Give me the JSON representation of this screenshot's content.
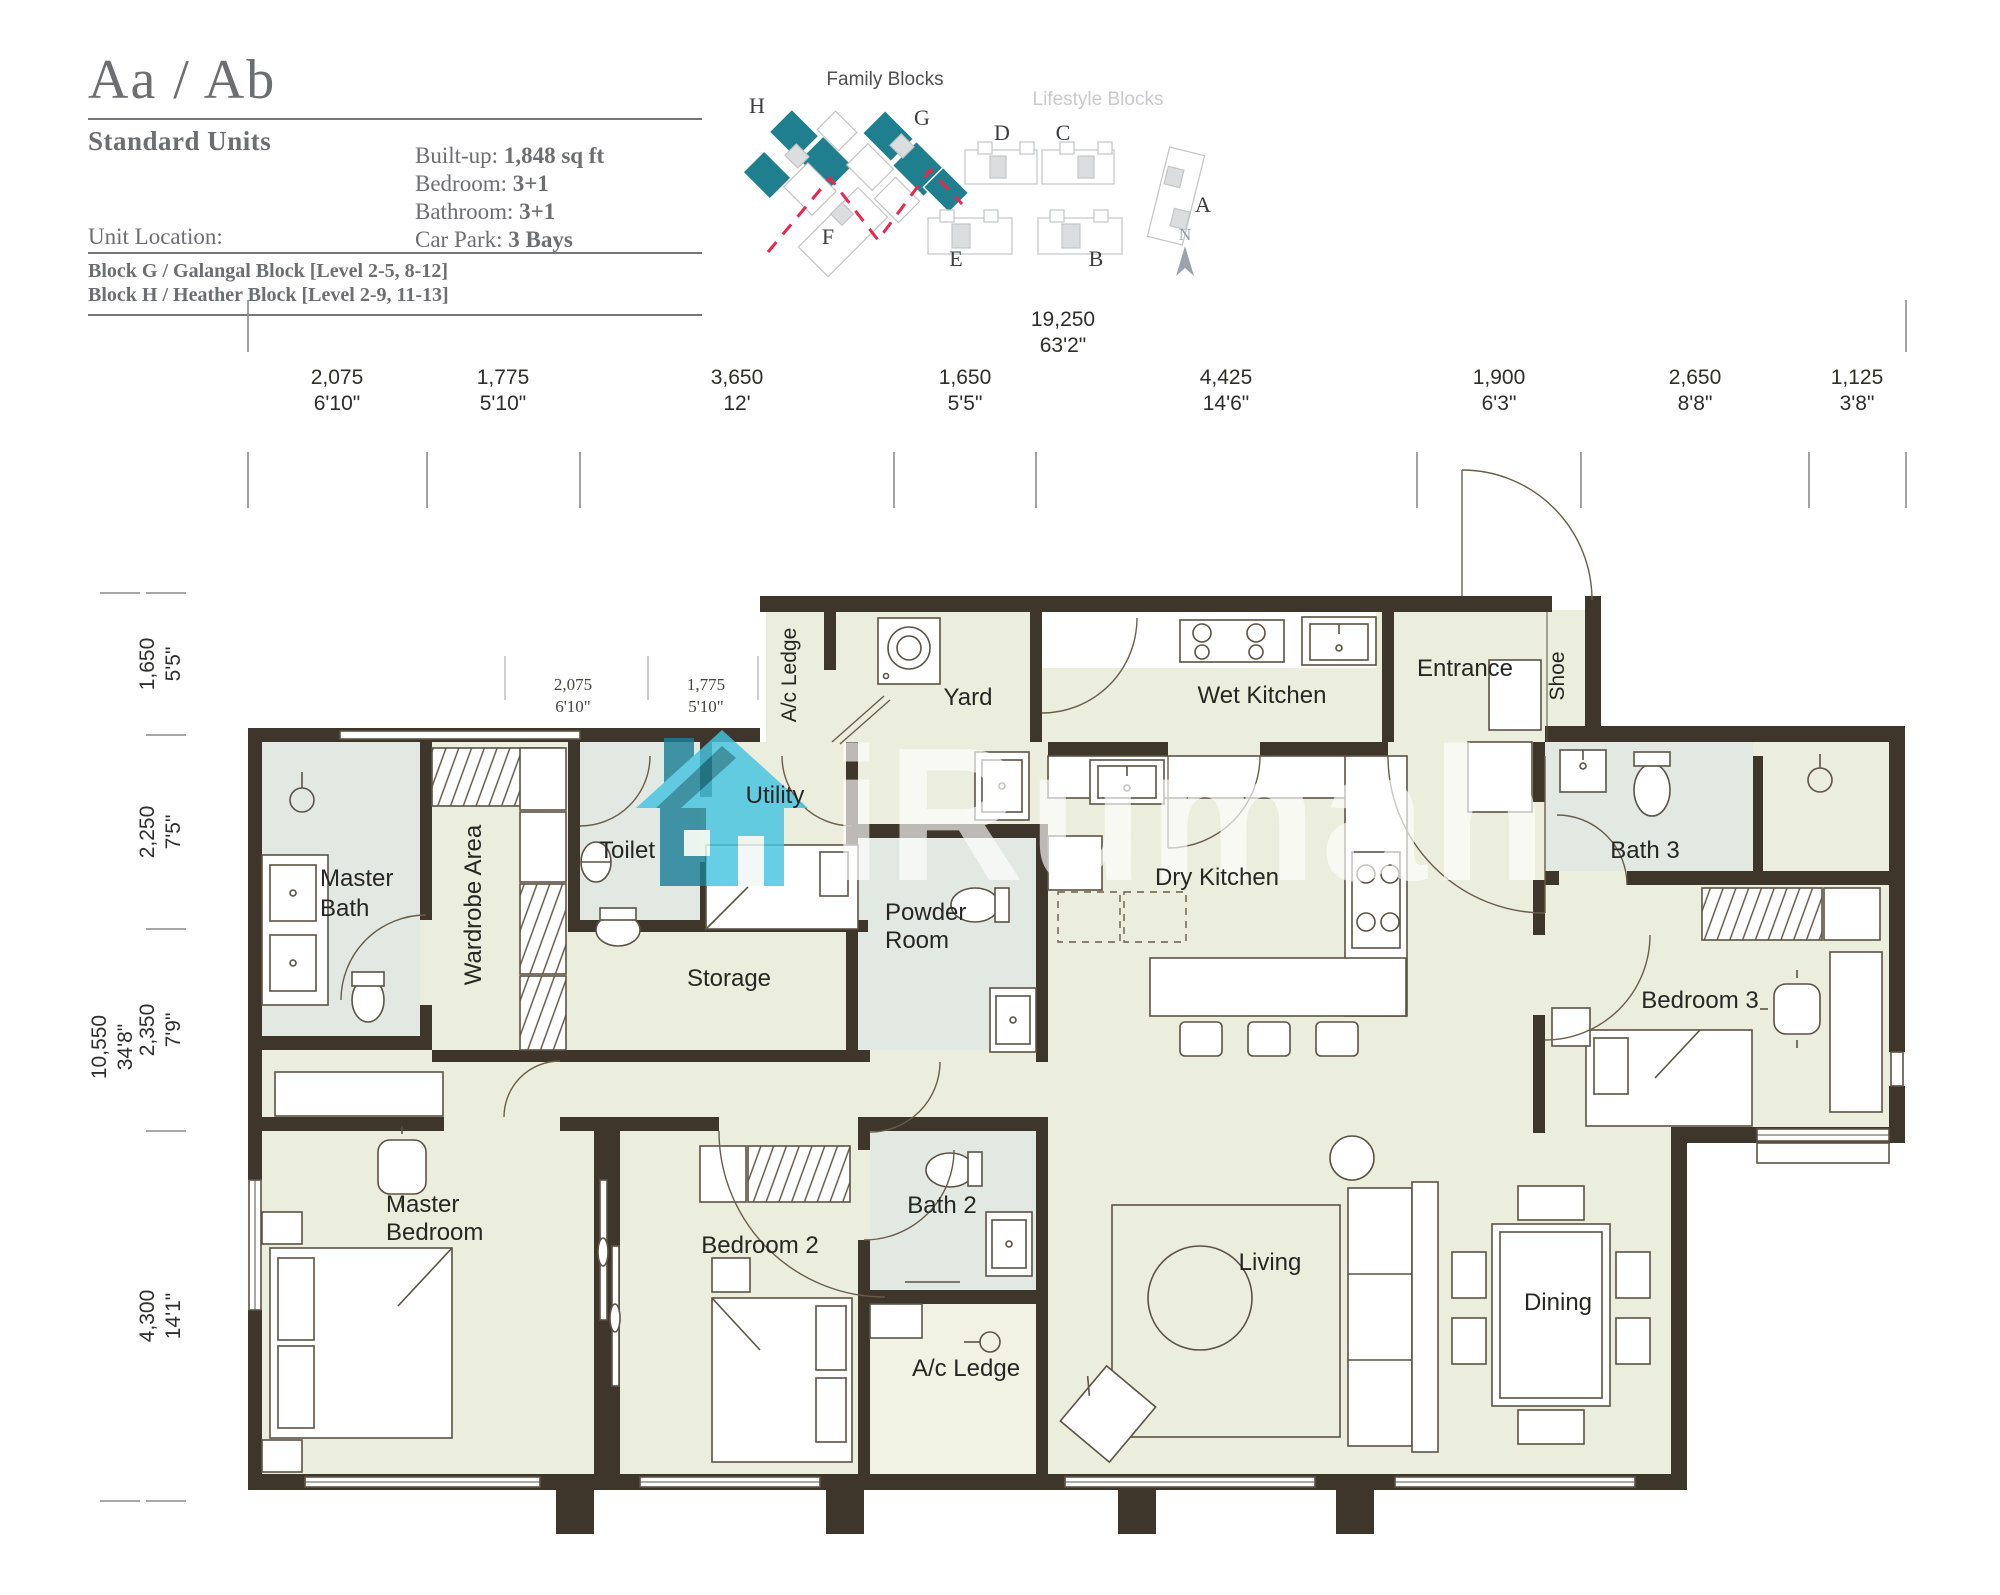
{
  "header": {
    "title": "Aa / Ab",
    "subtitle": "Standard Units",
    "unit_location_label": "Unit Location:",
    "specs": [
      {
        "label": "Built-up: ",
        "value": "1,848 sq ft"
      },
      {
        "label": "Bedroom: ",
        "value": "3+1"
      },
      {
        "label": "Bathroom: ",
        "value": "3+1"
      },
      {
        "label": "Car Park: ",
        "value": "3 Bays"
      }
    ],
    "blocks": [
      "Block G / Galangal Block [Level 2-5, 8-12]",
      "Block H / Heather Block [Level 2-9, 11-13]"
    ]
  },
  "site_plan": {
    "family_label": "Family Blocks",
    "lifestyle_label": "Lifestyle Blocks",
    "family_color": "#1f7f8e",
    "divider_color": "#e8274b",
    "block_letters": {
      "h": "H",
      "g": "G",
      "d": "D",
      "c": "C",
      "a": "A",
      "f": "F",
      "e": "E",
      "b": "B"
    },
    "compass_label": "N"
  },
  "watermark": {
    "text": "iRumah",
    "icon": "house-icon",
    "teal": "#45c4e0",
    "dark_teal": "#1c8096"
  },
  "dimensions": {
    "top_total": {
      "mm": "19,250",
      "ft": "63'2\""
    },
    "top": [
      {
        "mm": "2,075",
        "ft": "6'10\""
      },
      {
        "mm": "1,775",
        "ft": "5'10\""
      },
      {
        "mm": "3,650",
        "ft": "12'"
      },
      {
        "mm": "1,650",
        "ft": "5'5\""
      },
      {
        "mm": "4,425",
        "ft": "14'6\""
      },
      {
        "mm": "1,900",
        "ft": "6'3\""
      },
      {
        "mm": "2,650",
        "ft": "8'8\""
      },
      {
        "mm": "1,125",
        "ft": "3'8\""
      }
    ],
    "left_total": {
      "mm": "10,550",
      "ft": "34'8\""
    },
    "left": [
      {
        "mm": "1,650",
        "ft": "5'5\""
      },
      {
        "mm": "2,250",
        "ft": "7'5\""
      },
      {
        "mm": "2,350",
        "ft": "7'9\""
      },
      {
        "mm": "4,300",
        "ft": "14'1\""
      }
    ],
    "interior": [
      {
        "mm": "2,075",
        "ft": "6'10\""
      },
      {
        "mm": "1,775",
        "ft": "5'10\""
      },
      {
        "mm": "3,6",
        "ft": "1"
      },
      {
        "mm": "5",
        "ft": ""
      }
    ]
  },
  "rooms": {
    "ac_ledge_top": "A/c Ledge",
    "yard": "Yard",
    "wet_kitchen": "Wet Kitchen",
    "entrance": "Entrance",
    "shoe": "Shoe",
    "master_bath_1": "Master",
    "master_bath_2": "Bath",
    "wardrobe": "Wardrobe Area",
    "toilet": "Toilet",
    "utility": "Utility",
    "storage": "Storage",
    "powder_1": "Powder",
    "powder_2": "Room",
    "dry_kitchen": "Dry Kitchen",
    "bath3": "Bath 3",
    "bedroom3": "Bedroom 3",
    "master_bedroom_1": "Master",
    "master_bedroom_2": "Bedroom",
    "bedroom2": "Bedroom 2",
    "bath2": "Bath 2",
    "ac_ledge_bottom": "A/c Ledge",
    "living": "Living",
    "dining": "Dining"
  },
  "colors": {
    "wall": "#3e352b",
    "floor": "#ebeedc",
    "bath_floor": "#e2e9e3",
    "accent": "#1f7f8e",
    "divider_red": "#e8274b"
  }
}
